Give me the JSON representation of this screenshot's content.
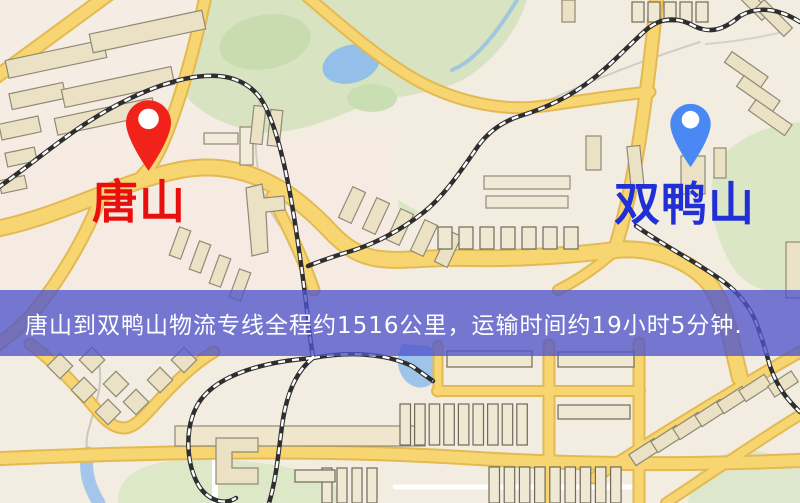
{
  "map": {
    "origin": {
      "name": "唐山",
      "marker_icon": "red-map-pin",
      "marker_color": "#f1221a",
      "label_color": "#e90f0f"
    },
    "destination": {
      "name": "双鸭山",
      "marker_icon": "blue-map-pin",
      "marker_color": "#4a89f3",
      "label_color": "#2130d6"
    },
    "banner": {
      "text": "唐山到双鸭山物流专线全程约1516公里，运输时间约19小时5分钟.",
      "background_color": "rgba(79,84,204,0.78)",
      "text_color": "#ffffff"
    },
    "route": {
      "distance_km": "1516",
      "duration": "19小时5分钟"
    },
    "theme": {
      "background_color": "#f3ece0",
      "road_color": "#f7d672",
      "road_casing_color": "#e3b952",
      "park_color": "#d7e3c1",
      "water_color": "#a3c6ea",
      "building_color": "#ebe2c6",
      "railway_color": "#2e2e2e"
    }
  }
}
